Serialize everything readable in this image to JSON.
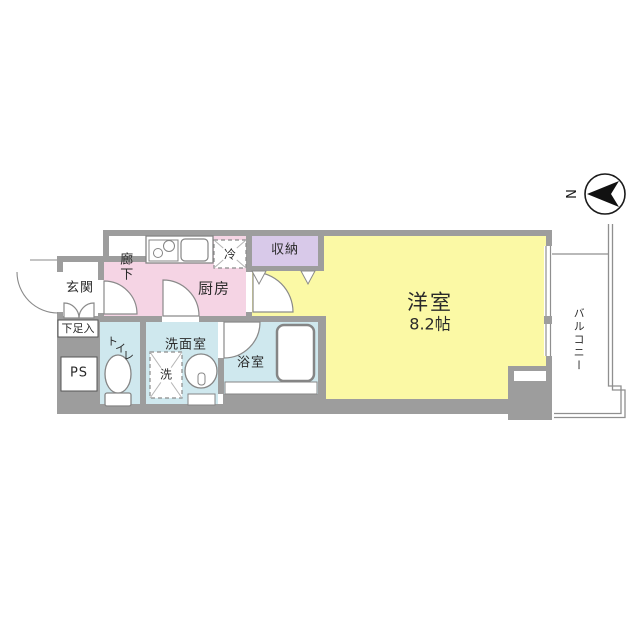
{
  "compass": {
    "north_label": "N"
  },
  "rooms": {
    "genkan": {
      "label": "玄関"
    },
    "shoe_box": {
      "label": "下足入"
    },
    "pipe_space": {
      "label": "PS"
    },
    "hallway": {
      "label": "廊下"
    },
    "kitchen": {
      "label": "厨房"
    },
    "fridge": {
      "label": "冷"
    },
    "closet": {
      "label": "収納"
    },
    "toilet": {
      "label": "トイレ"
    },
    "washroom": {
      "label": "洗面室"
    },
    "washer": {
      "label": "洗"
    },
    "bathroom": {
      "label": "浴室"
    },
    "western_room": {
      "label": "洋室",
      "size_label": "8.2帖"
    },
    "balcony": {
      "label": "バルコニー"
    }
  },
  "colors": {
    "room_pink": "#f5d4e4",
    "room_yellow": "#fbf9a5",
    "room_blue": "#cfe8ee",
    "room_purple": "#d8c9e9",
    "wall_gray": "#9d9d9d",
    "line_gray": "#8f8f8f",
    "text_color": "#2a2a2a"
  }
}
